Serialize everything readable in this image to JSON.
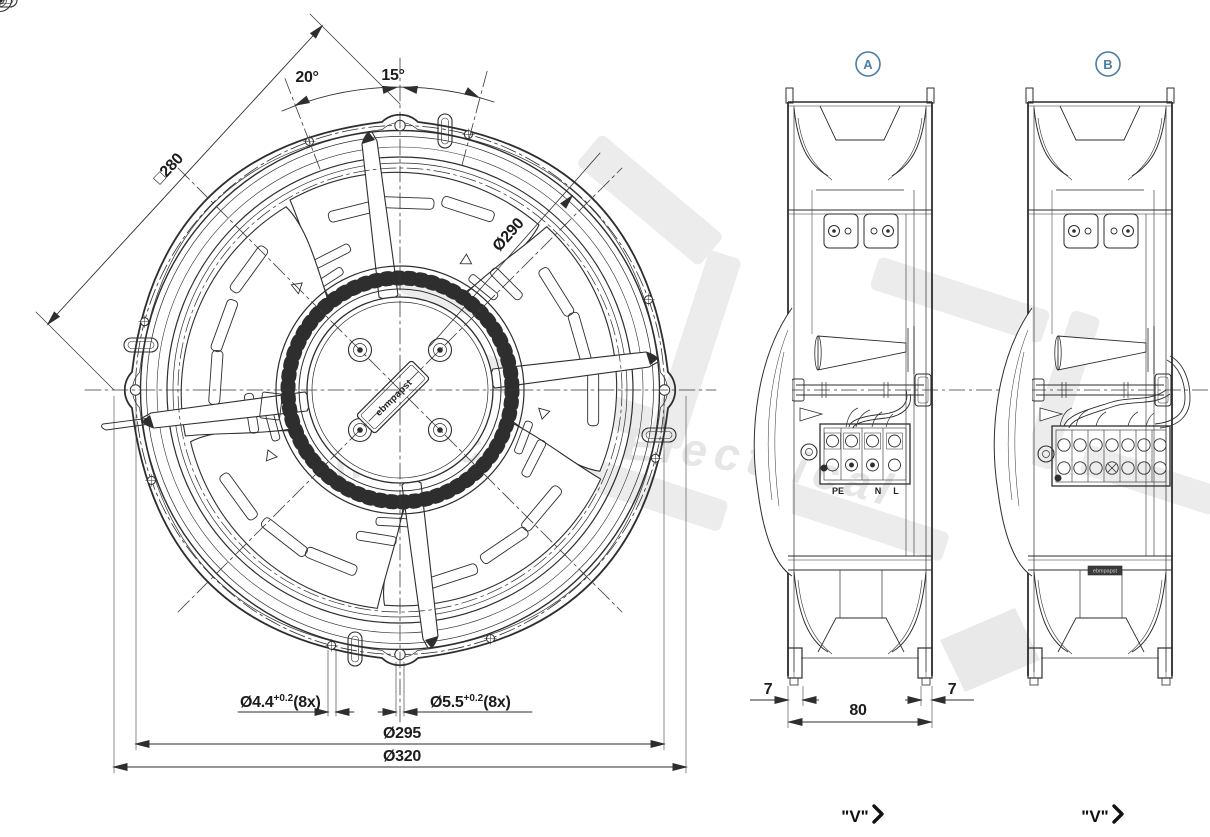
{
  "front_view": {
    "dim_square": "□280",
    "angle_left": "20°",
    "angle_right": "15°",
    "dia_ring": "Ø290",
    "hole_small_dia": "Ø4.4",
    "hole_small_tol": "+0.2",
    "hole_small_count": "(8x)",
    "hole_large_dia": "Ø5.5",
    "hole_large_tol": "+0.2",
    "hole_large_count": "(8x)",
    "dia_bolt_circle": "Ø295",
    "dia_outer": "Ø320",
    "hub_brand": "ebmpapst"
  },
  "side_view_a": {
    "label": "A",
    "terminals": {
      "pe": "PE",
      "n": "N",
      "l": "L"
    },
    "dim_foot_left": "7",
    "dim_width": "80",
    "dim_foot_right": "7",
    "view_dir": "\"V\""
  },
  "side_view_b": {
    "label": "B",
    "view_dir": "\"V\"",
    "nameplate": "ebmpapst"
  },
  "watermark": {
    "script_text": "Mechanical & Electrical"
  },
  "colors": {
    "line": "#2e2e2e",
    "accent": "#4a7ca8",
    "watermark": "#e8e8e8",
    "background": "#ffffff"
  }
}
